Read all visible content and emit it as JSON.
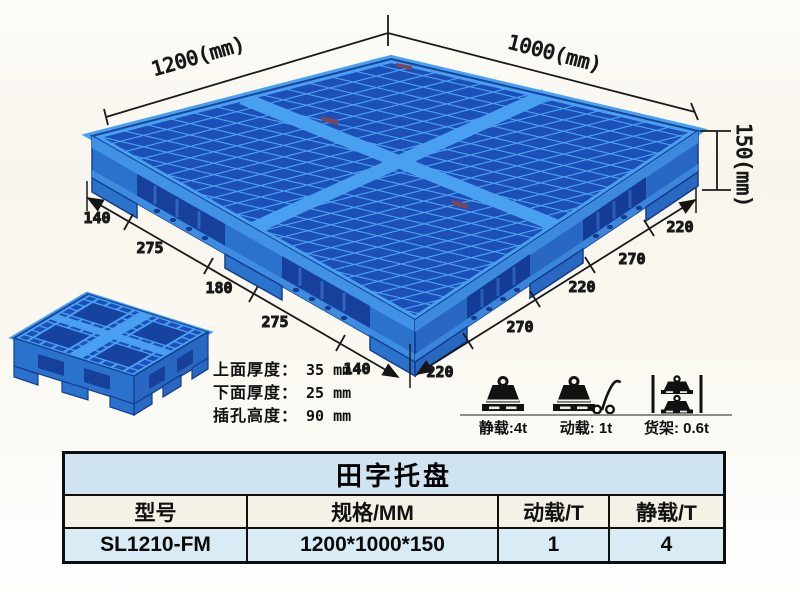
{
  "illustration": {
    "dim_length_label": "1200(mm)",
    "dim_width_label": "1000(mm)",
    "dim_height_label": "150(mm)",
    "bottom_left_dims": [
      "140",
      "275",
      "180",
      "275",
      "140"
    ],
    "bottom_right_dims": [
      "220",
      "270",
      "220",
      "270",
      "220"
    ]
  },
  "notes": [
    {
      "label": "上面厚度：",
      "value": "35 mm"
    },
    {
      "label": "下面厚度：",
      "value": "25 mm"
    },
    {
      "label": "插孔高度：",
      "value": "90 mm"
    }
  ],
  "loads": [
    {
      "icon": "static-load-icon",
      "label": "静载:4t"
    },
    {
      "icon": "dynamic-load-icon",
      "label": "动载: 1t"
    },
    {
      "icon": "rack-load-icon",
      "label": "货架: 0.6t"
    }
  ],
  "table": {
    "title": "田字托盘",
    "headers": [
      "型号",
      "规格/MM",
      "动载/T",
      "静载/T"
    ],
    "rows": [
      [
        "SL1210-FM",
        "1200*1000*150",
        "1",
        "4"
      ]
    ]
  },
  "colors": {
    "pallet_blue": "#2b72cc",
    "pallet_rib": "#4aa0f0",
    "pallet_hole": "#173f9c",
    "dimension_line": "#1a1a1a",
    "table_title_bg": "#cfe3f0",
    "table_header_bg": "#f5f1e6",
    "table_row_bg": "#d9ecf5"
  }
}
